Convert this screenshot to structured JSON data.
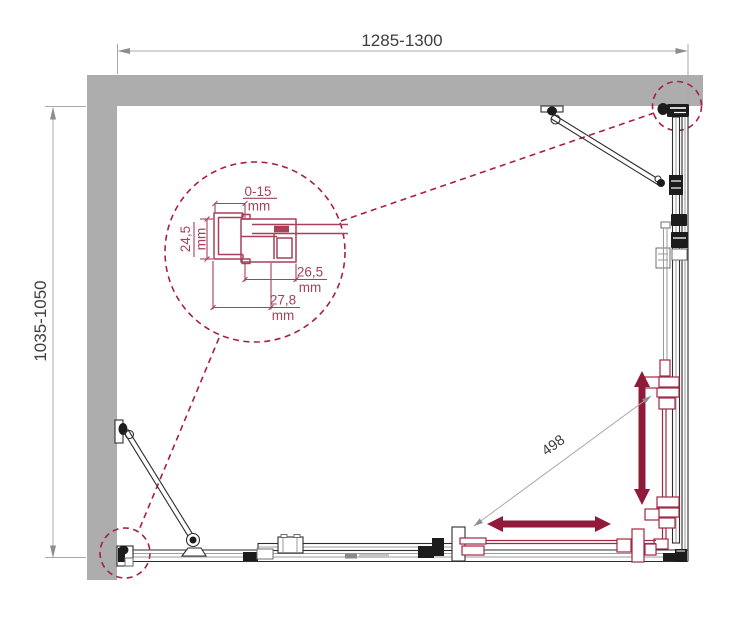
{
  "drawing": {
    "type": "shower-enclosure-plan-view",
    "dimensions": {
      "width": "1285-1300",
      "depth": "1035-1050",
      "entry_diagonal": "498"
    },
    "detail_dimensions": {
      "adjustment": {
        "value": "0-15",
        "unit": "mm"
      },
      "profile_depth": {
        "value": "24,5",
        "unit": "mm"
      },
      "channel_width": {
        "value": "26,5",
        "unit": "mm"
      },
      "profile_width": {
        "value": "27,8",
        "unit": "mm"
      }
    },
    "colors": {
      "wall": "#ADADAD",
      "line": "#2E2E2E",
      "hardware": "#1C1C1C",
      "dim-line": "#A9A9A9",
      "dim-arrow": "#8E8E8E",
      "dim-text": "#3E3E3E",
      "accent": "#A81E45",
      "arrow": "#8F1A39",
      "profile": "#A64159",
      "door": "#A02844",
      "track": "#9A9A9A",
      "paper": "#FFFFFF"
    }
  }
}
